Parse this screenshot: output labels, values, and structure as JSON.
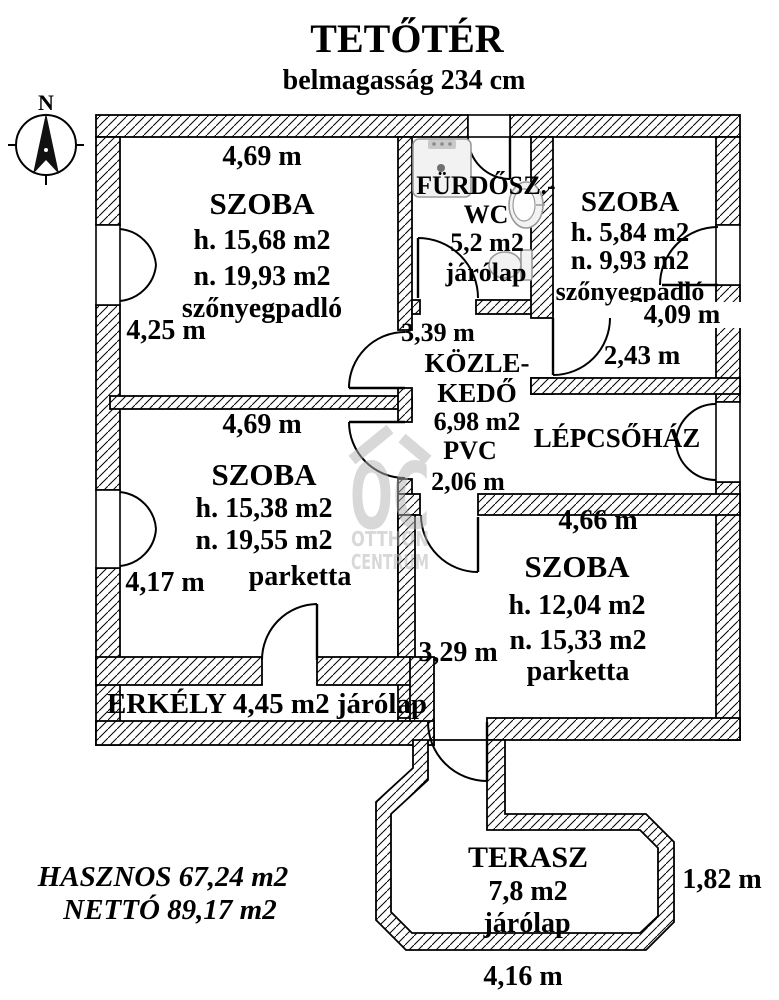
{
  "colors": {
    "ink": "#000000",
    "paper": "#ffffff",
    "watermark": "#b3b3b3",
    "fixture": "#f2f2f2"
  },
  "header": {
    "title": "TETŐTÉR",
    "subtitle": "belmagasság 234 cm"
  },
  "compass": {
    "north": "N"
  },
  "rooms": {
    "szoba1": {
      "dim_top": "4,69 m",
      "name": "SZOBA",
      "area_h": "h. 15,68 m2",
      "area_n": "n. 19,93 m2",
      "floor": "szőnyegpadló",
      "dim_left": "4,25 m"
    },
    "furdoszoba": {
      "name1": "FÜRDŐSZ.-",
      "name2": "WC",
      "area": "5,2 m2",
      "floor": "járólap"
    },
    "szoba2": {
      "name": "SZOBA",
      "area_h": "h. 5,84 m2",
      "area_n": "n. 9,93 m2",
      "floor": "szőnyegpadló",
      "dim_right": "4,09 m",
      "dim_bottom": "2,43 m"
    },
    "kozlekedo": {
      "dim_top": "3,39 m",
      "name1": "KÖZLE-",
      "name2": "KEDŐ",
      "area": "6,98 m2",
      "floor": "PVC",
      "dim_bottom": "2,06 m"
    },
    "lepcsohaz": {
      "name": "LÉPCSŐHÁZ"
    },
    "szoba3": {
      "dim_top": "4,69 m",
      "name": "SZOBA",
      "area_h": "h. 15,38 m2",
      "area_n": "n. 19,55 m2",
      "floor": "parketta",
      "dim_left": "4,17 m"
    },
    "szoba4": {
      "dim_top": "4,66 m",
      "name": "SZOBA",
      "area_h": "h. 12,04 m2",
      "area_n": "n. 15,33 m2",
      "floor": "parketta",
      "dim_left": "3,29 m"
    },
    "erkely": {
      "label": "ERKÉLY 4,45 m2 járólap"
    },
    "terasz": {
      "name": "TERASZ",
      "area": "7,8 m2",
      "floor": "járólap",
      "dim_right": "1,82 m",
      "dim_bottom": "4,16 m"
    }
  },
  "summary": {
    "hasznos": "HASZNOS 67,24 m2",
    "netto": "NETTÓ 89,17 m2"
  },
  "watermark": {
    "logo": "OC",
    "line1": "OTTHON",
    "line2": "CENTRUM"
  }
}
